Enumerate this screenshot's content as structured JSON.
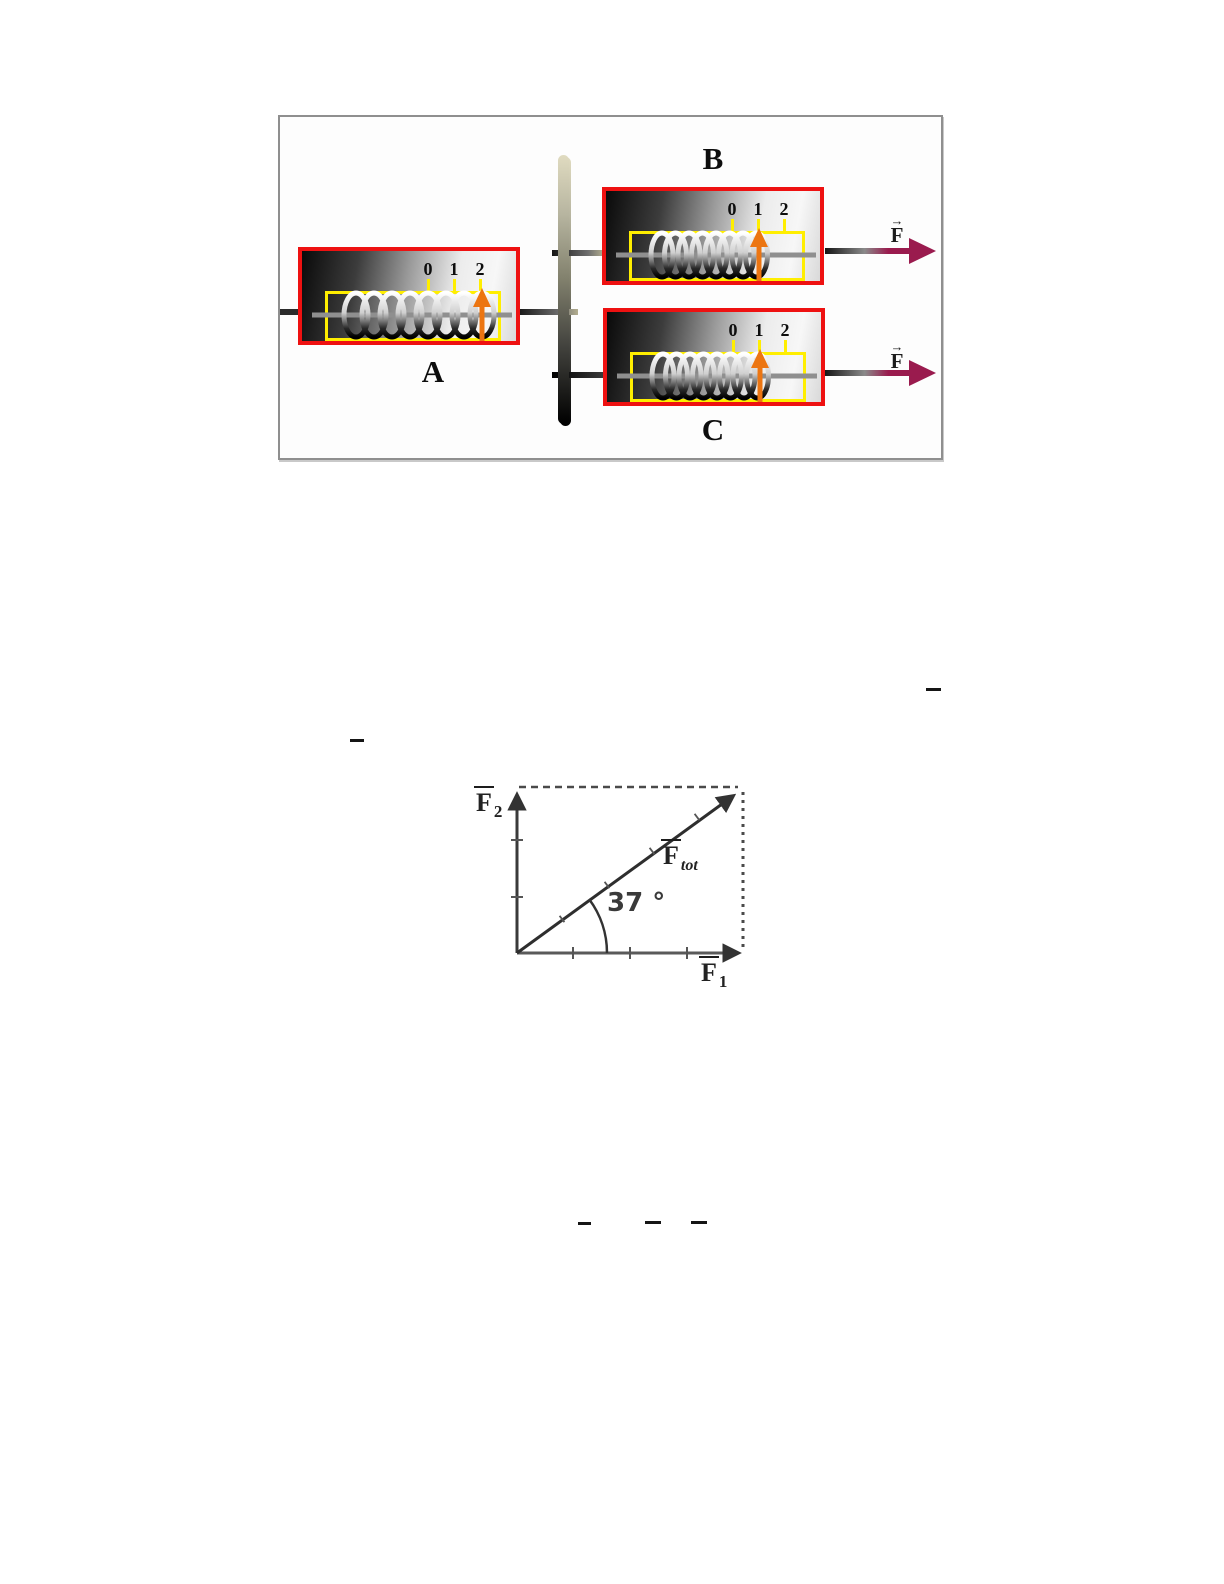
{
  "colors": {
    "box_border": "#ee1111",
    "scale_frame": "#ffee00",
    "pointer": "#ec7511",
    "force_arrow": "#9a1b4e"
  },
  "spring_figure": {
    "label_a": "A",
    "label_b": "B",
    "label_c": "C",
    "scale_marks": [
      "0",
      "1",
      "2"
    ],
    "force_label": "F",
    "vector_arrow": "→"
  },
  "vector_figure": {
    "angle_label": "37 °",
    "f1_letter": "F",
    "f1_sub": "1",
    "f2_letter": "F",
    "f2_sub": "2",
    "ftot_letter": "F",
    "ftot_sub": "tot"
  }
}
